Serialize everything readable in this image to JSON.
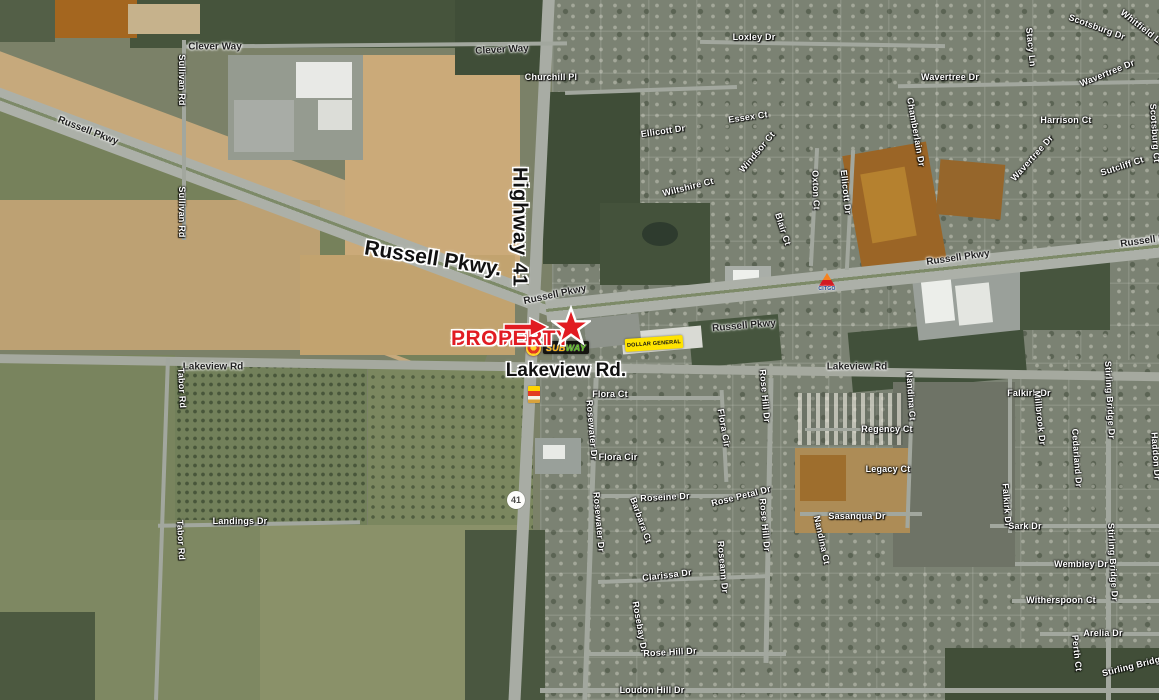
{
  "map": {
    "subject": {
      "line1": "SUBJECT",
      "line2": "PROPERTY"
    },
    "major_roads": {
      "highway": "Highway 41",
      "russell": "Russell Pkwy.",
      "lakeview": "Lakeview Rd."
    },
    "route_shield": "41",
    "logos": {
      "subway_sub": "SUB",
      "subway_way": "WAY",
      "dollar_general": "DOLLAR GENERAL",
      "citgo": "CITGO"
    },
    "colors": {
      "subject_red": "#e11b22",
      "dg_yellow": "#ffe300",
      "subway_yellow": "#ffb612",
      "subway_green": "#5dbf21",
      "citgo_blue": "#1b3e93",
      "citgo_orange": "#f58220",
      "citgo_red": "#d31a21"
    },
    "labels": [
      {
        "t": "Russell Pkwy",
        "x": 88,
        "y": 131,
        "r": 21,
        "c": "rd"
      },
      {
        "t": "Clever Way",
        "x": 215,
        "y": 47,
        "r": 0,
        "c": "rd"
      },
      {
        "t": "Clever Way",
        "x": 502,
        "y": 50,
        "r": -3,
        "c": "rd"
      },
      {
        "t": "Sullivan Rd",
        "x": 182,
        "y": 80,
        "r": 90,
        "c": "st"
      },
      {
        "t": "Sullivan Rd",
        "x": 182,
        "y": 212,
        "r": 90,
        "c": "st"
      },
      {
        "t": "Churchill Pl",
        "x": 551,
        "y": 77,
        "r": 0,
        "c": "st"
      },
      {
        "t": "Loxley Dr",
        "x": 754,
        "y": 37,
        "r": 0,
        "c": "st"
      },
      {
        "t": "Ellicott Dr",
        "x": 663,
        "y": 131,
        "r": -8,
        "c": "st"
      },
      {
        "t": "Essex Ct",
        "x": 748,
        "y": 117,
        "r": -8,
        "c": "st"
      },
      {
        "t": "Wiltshire Ct",
        "x": 688,
        "y": 187,
        "r": -14,
        "c": "st"
      },
      {
        "t": "Windsor Ct",
        "x": 757,
        "y": 152,
        "r": -50,
        "c": "st"
      },
      {
        "t": "Oxton Ct",
        "x": 816,
        "y": 190,
        "r": 88,
        "c": "st"
      },
      {
        "t": "Ellicott Dr",
        "x": 846,
        "y": 192,
        "r": 84,
        "c": "st"
      },
      {
        "t": "Blair Ct",
        "x": 783,
        "y": 229,
        "r": 72,
        "c": "st"
      },
      {
        "t": "Chamberlain Dr",
        "x": 916,
        "y": 132,
        "r": 80,
        "c": "st"
      },
      {
        "t": "Wavertree Dr",
        "x": 950,
        "y": 77,
        "r": 0,
        "c": "st"
      },
      {
        "t": "Wavertree Dr",
        "x": 1107,
        "y": 73,
        "r": -22,
        "c": "st"
      },
      {
        "t": "Wavertree Dr",
        "x": 1032,
        "y": 158,
        "r": -48,
        "c": "st"
      },
      {
        "t": "Scotsburg Dr",
        "x": 1097,
        "y": 27,
        "r": 20,
        "c": "st"
      },
      {
        "t": "Whitfield Ln",
        "x": 1143,
        "y": 28,
        "r": 38,
        "c": "st"
      },
      {
        "t": "Stacy Ln",
        "x": 1031,
        "y": 47,
        "r": 84,
        "c": "st"
      },
      {
        "t": "Harrison Ct",
        "x": 1066,
        "y": 120,
        "r": 0,
        "c": "st"
      },
      {
        "t": "Scotsburg Ct",
        "x": 1155,
        "y": 133,
        "r": 86,
        "c": "st"
      },
      {
        "t": "Sutcliff Ct",
        "x": 1122,
        "y": 166,
        "r": -18,
        "c": "st"
      },
      {
        "t": "Russell Pkwy",
        "x": 555,
        "y": 295,
        "r": -12,
        "c": "rd"
      },
      {
        "t": "Russell Pkwy",
        "x": 744,
        "y": 326,
        "r": -5,
        "c": "rd"
      },
      {
        "t": "Russell Pkwy",
        "x": 958,
        "y": 258,
        "r": -8,
        "c": "rd"
      },
      {
        "t": "Russell Pkwy",
        "x": 1152,
        "y": 240,
        "r": -8,
        "c": "rd"
      },
      {
        "t": "Lakeview Rd",
        "x": 213,
        "y": 367,
        "r": 0,
        "c": "rd"
      },
      {
        "t": "Lakeview Rd",
        "x": 857,
        "y": 367,
        "r": 0,
        "c": "rd"
      },
      {
        "t": "Flora Ct",
        "x": 610,
        "y": 394,
        "r": 0,
        "c": "st"
      },
      {
        "t": "Flora Cir",
        "x": 618,
        "y": 457,
        "r": 0,
        "c": "st"
      },
      {
        "t": "Flora Cir",
        "x": 724,
        "y": 428,
        "r": 80,
        "c": "st"
      },
      {
        "t": "Rosewater Dr",
        "x": 592,
        "y": 430,
        "r": 85,
        "c": "st"
      },
      {
        "t": "Rosewater Dr",
        "x": 599,
        "y": 522,
        "r": 85,
        "c": "st"
      },
      {
        "t": "Roseine Dr",
        "x": 665,
        "y": 497,
        "r": -3,
        "c": "st"
      },
      {
        "t": "Rose Petal Dr",
        "x": 741,
        "y": 496,
        "r": -14,
        "c": "st"
      },
      {
        "t": "Rose Hill Dr",
        "x": 765,
        "y": 396,
        "r": 85,
        "c": "st"
      },
      {
        "t": "Rose Hill Dr",
        "x": 765,
        "y": 525,
        "r": 85,
        "c": "st"
      },
      {
        "t": "Barbara Ct",
        "x": 641,
        "y": 520,
        "r": 70,
        "c": "st"
      },
      {
        "t": "Clarissa Dr",
        "x": 667,
        "y": 575,
        "r": -7,
        "c": "st"
      },
      {
        "t": "Roseann Dr",
        "x": 723,
        "y": 567,
        "r": 85,
        "c": "st"
      },
      {
        "t": "Rosebay Dr",
        "x": 640,
        "y": 627,
        "r": 80,
        "c": "st"
      },
      {
        "t": "Rose Hill Dr",
        "x": 670,
        "y": 652,
        "r": -3,
        "c": "st"
      },
      {
        "t": "Loudon Hill Dr",
        "x": 652,
        "y": 690,
        "r": 0,
        "c": "st"
      },
      {
        "t": "Landings Dr",
        "x": 240,
        "y": 521,
        "r": 0,
        "c": "st"
      },
      {
        "t": "Tabor Rd",
        "x": 182,
        "y": 388,
        "r": 87,
        "c": "st"
      },
      {
        "t": "Tabor Rd",
        "x": 181,
        "y": 540,
        "r": 87,
        "c": "st"
      },
      {
        "t": "Regency Ct",
        "x": 887,
        "y": 429,
        "r": 0,
        "c": "st"
      },
      {
        "t": "Legacy Ct",
        "x": 888,
        "y": 469,
        "r": 0,
        "c": "st"
      },
      {
        "t": "Sasanqua Dr",
        "x": 857,
        "y": 516,
        "r": 0,
        "c": "st"
      },
      {
        "t": "Nandina Ct",
        "x": 911,
        "y": 396,
        "r": 86,
        "c": "st"
      },
      {
        "t": "Nandina Ct",
        "x": 822,
        "y": 540,
        "r": 78,
        "c": "st"
      },
      {
        "t": "Falkirk Dr",
        "x": 1029,
        "y": 393,
        "r": 0,
        "c": "st"
      },
      {
        "t": "Falkirk Dr",
        "x": 1007,
        "y": 505,
        "r": 86,
        "c": "st"
      },
      {
        "t": "Millbrook Dr",
        "x": 1040,
        "y": 418,
        "r": 84,
        "c": "st"
      },
      {
        "t": "Stirling Bridge Dr",
        "x": 1110,
        "y": 400,
        "r": 87,
        "c": "st"
      },
      {
        "t": "Cedarland Dr",
        "x": 1077,
        "y": 458,
        "r": 86,
        "c": "st"
      },
      {
        "t": "Haddon Dr",
        "x": 1156,
        "y": 456,
        "r": 86,
        "c": "st"
      },
      {
        "t": "Sark Dr",
        "x": 1025,
        "y": 526,
        "r": 0,
        "c": "st"
      },
      {
        "t": "Wembley Dr",
        "x": 1081,
        "y": 564,
        "r": 0,
        "c": "st"
      },
      {
        "t": "Stirling Bridge Dr",
        "x": 1113,
        "y": 562,
        "r": 87,
        "c": "st"
      },
      {
        "t": "Witherspoon Ct",
        "x": 1061,
        "y": 600,
        "r": 0,
        "c": "st"
      },
      {
        "t": "Arelia Dr",
        "x": 1103,
        "y": 633,
        "r": 0,
        "c": "st"
      },
      {
        "t": "Perth Ct",
        "x": 1077,
        "y": 653,
        "r": 84,
        "c": "st"
      },
      {
        "t": "Stirling Bridge Dr",
        "x": 1140,
        "y": 664,
        "r": -14,
        "c": "st"
      }
    ]
  }
}
